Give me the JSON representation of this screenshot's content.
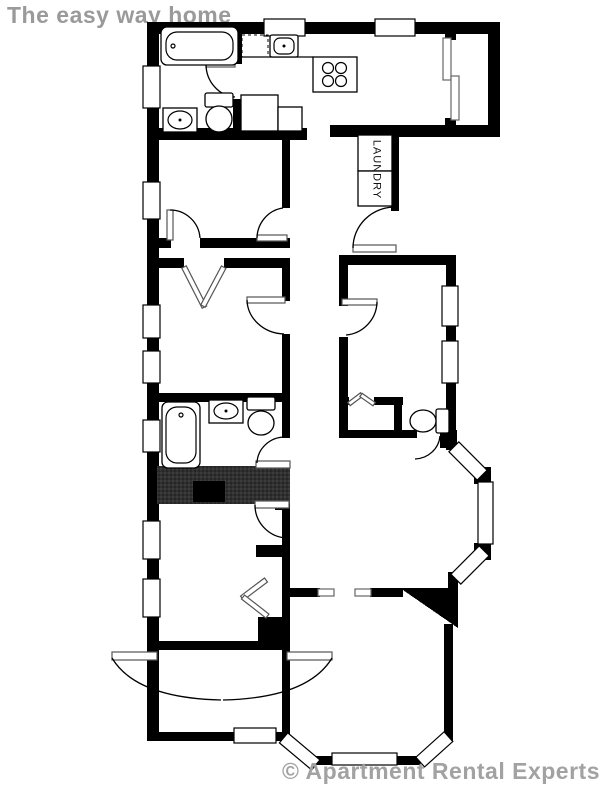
{
  "title": {
    "text": "The easy way home",
    "color": "#9a9a9a"
  },
  "watermark": {
    "text": "© Apartment Rental Experts",
    "color": "#a2a2a2"
  },
  "floor_plan": {
    "labels": {
      "laundry": "LAUNDRY"
    },
    "colors": {
      "wall": "#000000",
      "background": "#ffffff",
      "stairs_fill": "#303030",
      "stairs_inner": "#000000",
      "trim_gray": "#666666"
    },
    "icons": [
      "bathtub-icon",
      "bathroom-sink-icon",
      "toilet-icon",
      "kitchen-sink-icon",
      "dishwasher-icon",
      "stove-icon",
      "refrigerator-icon",
      "washer-dryer-icon",
      "sliding-door-icon",
      "closet-bifold-icon",
      "window-icon",
      "door-arc-icon",
      "stairs-icon",
      "bay-window-icon",
      "double-entry-door-icon"
    ]
  }
}
